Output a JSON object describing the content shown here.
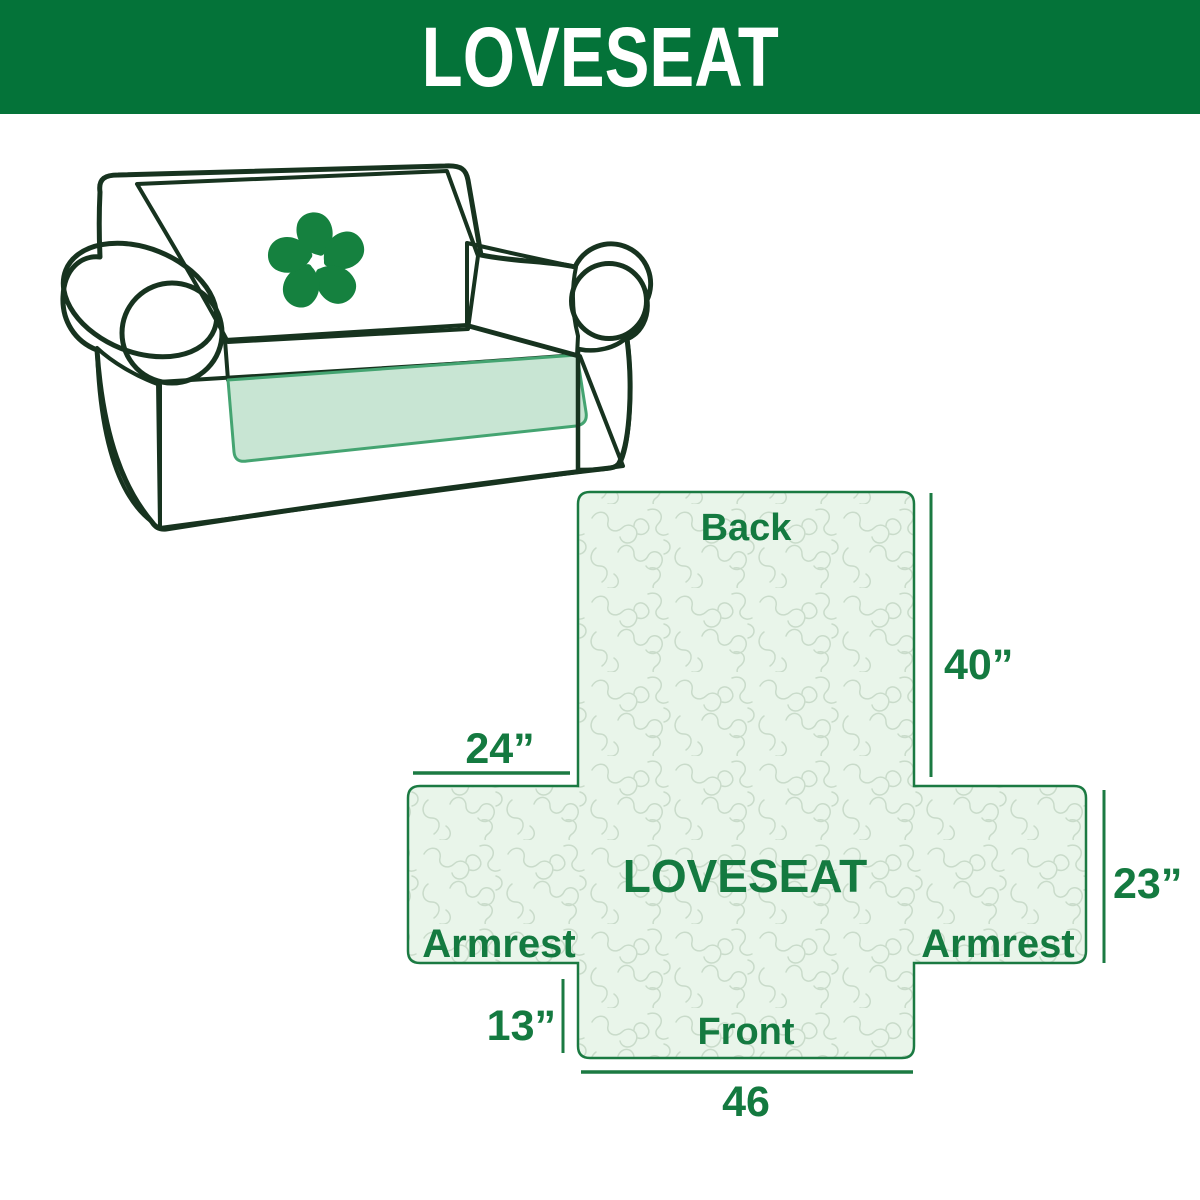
{
  "header": {
    "title": "LOVESEAT"
  },
  "illustration": {
    "alt": "Line drawing of a loveseat sofa with a mint green slipcover",
    "logo_icon": "pinwheel-icon"
  },
  "diagram": {
    "center_label": "LOVESEAT",
    "back_label": "Back",
    "front_label": "Front",
    "armrest_left_label": "Armrest",
    "armrest_right_label": "Armrest",
    "dim_back_height": "40”",
    "dim_armrest_width": "24”",
    "dim_side_height": "23”",
    "dim_front_height": "13”",
    "dim_front_width": "46"
  },
  "colors": {
    "header_bg": "#047339",
    "header_text": "#ffffff",
    "diagram_border": "#1b7a42",
    "diagram_fill": "#e9f5ea",
    "diagram_pattern_lines": "#c9dbca",
    "label_text": "#147a40",
    "sofa_outline": "#17331f",
    "cover_mint": "#c8e5d3",
    "skirt_edge_green": "#44a471",
    "logo_green": "#15813f"
  }
}
